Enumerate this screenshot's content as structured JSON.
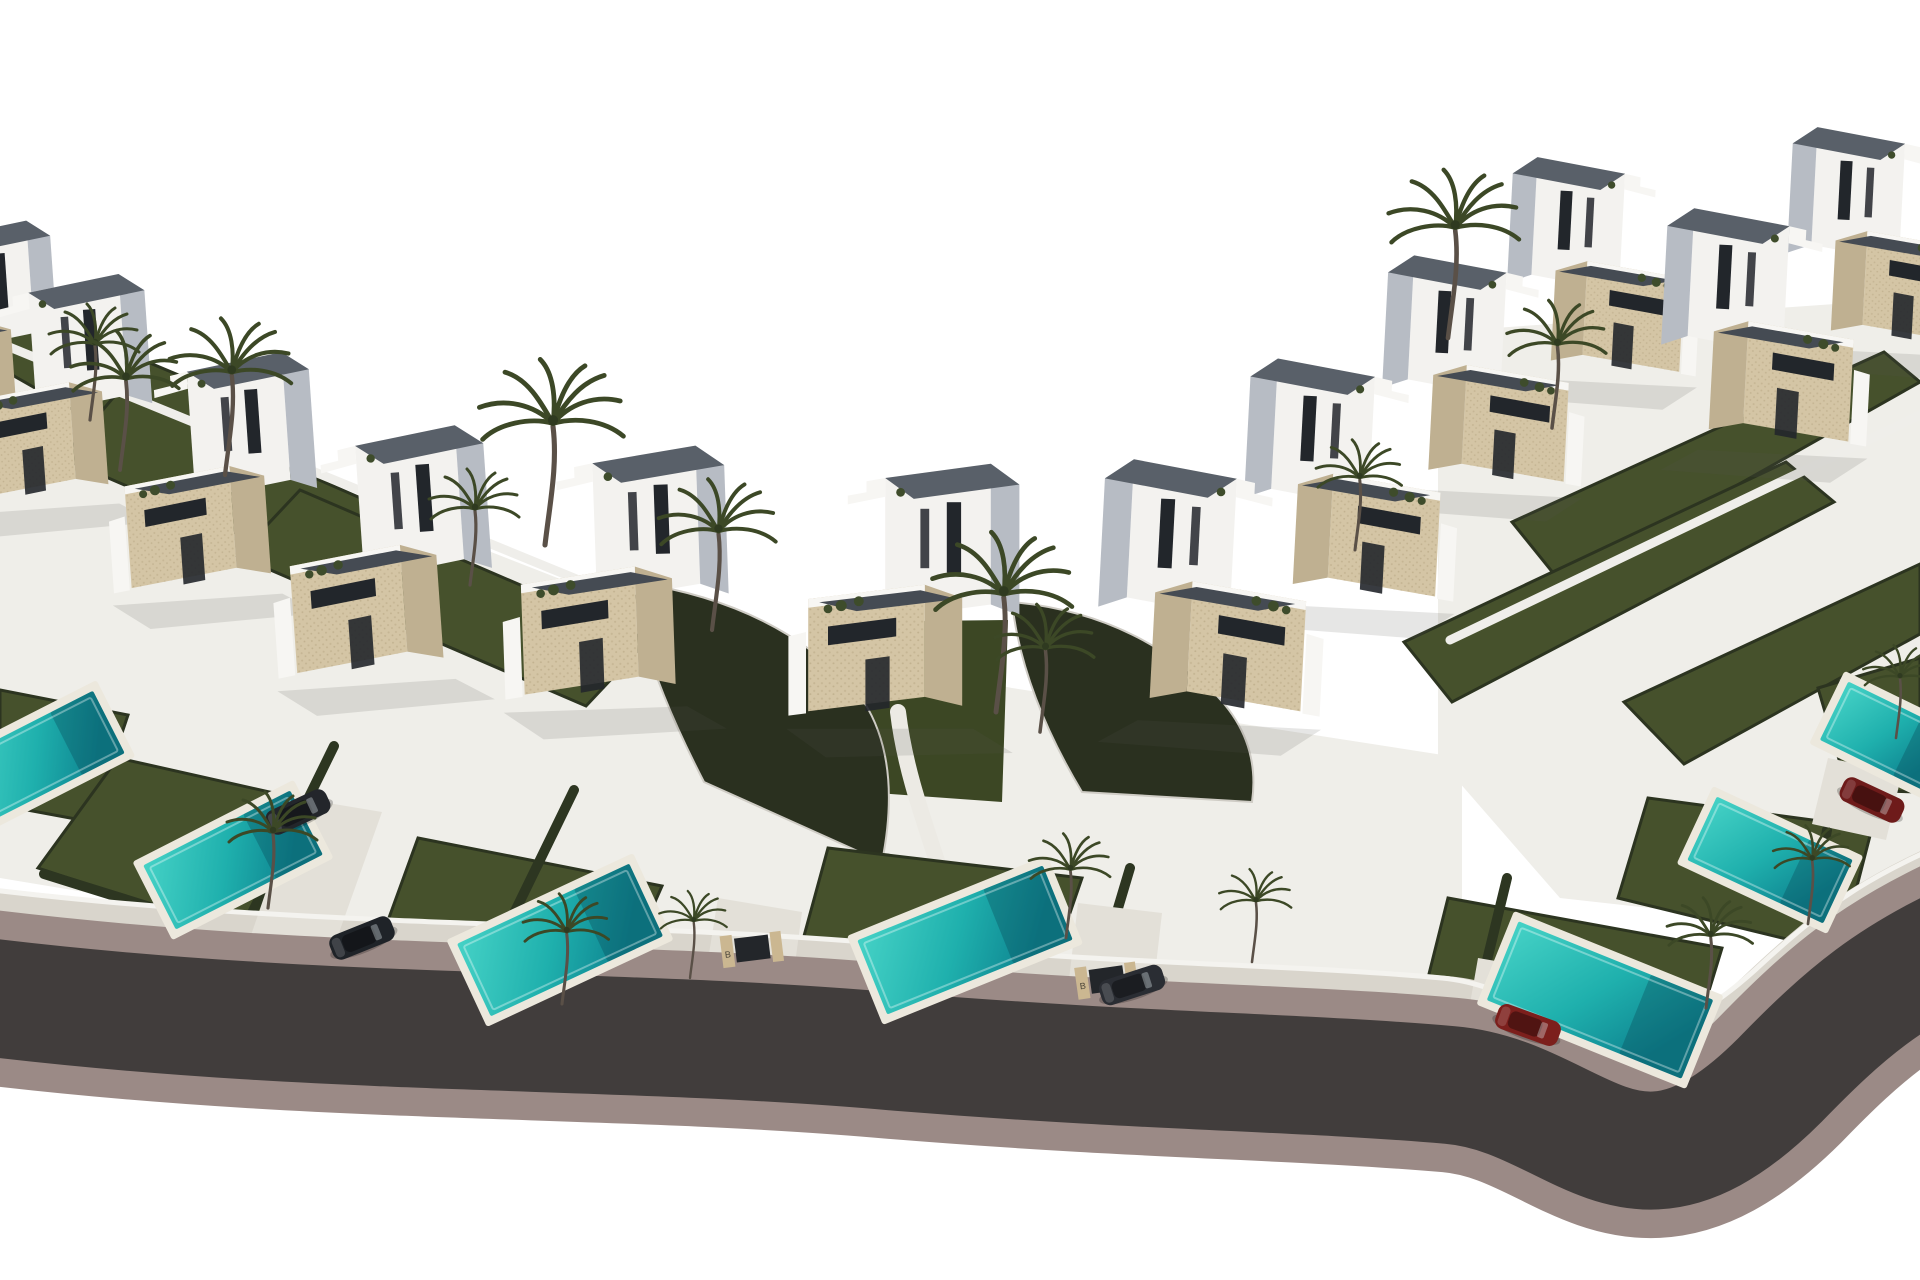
{
  "meta": {
    "description": "Aerial 3D architectural render of a gated development of modern two-storey villas with private pools and palm trees arranged along a sweeping curved road",
    "style": "computer generated real-estate visualization, white sky background"
  },
  "scene": {
    "width": 1920,
    "height": 1280,
    "colors": {
      "background": "#ffffff",
      "ground_tint": "#efeee9",
      "villa_white": "#f3f2ef",
      "villa_shadow": "#b7bcc4",
      "villa_trim": "#f7f6f3",
      "stone": "#d4c5a5",
      "stone_dark": "#bfb091",
      "roof": "#596069",
      "roof_dark": "#454b53",
      "window": "#22262b",
      "lawn": "#46512c",
      "lawn_valley": "#3c4724",
      "lawn_edge": "#2c3420",
      "hedge": "#2d3621",
      "embankment": "#2a301f",
      "pool_deck": "#ece8dd",
      "pool_light": "#45d2c6",
      "pool_mid": "#1fb0ad",
      "pool_deep": "#0e8490",
      "paving": "#dcd8cf",
      "driveway": "#e3e0d8",
      "sidewalk": "#d9d5cc",
      "curb": "#9b8a86",
      "asphalt": "#413d3c",
      "fence": "#f4f3ef",
      "wall": "#efeeea",
      "palm_frond": "#3c4826",
      "palm_trunk": "#5a5047",
      "shrub": "#3e4c2b",
      "shadow_soft": "rgba(90,90,80,0.15)"
    },
    "base_tints": [
      {
        "points": "0,360 660,618 1012,688 1012,1046 0,878"
      },
      {
        "points": "1012,688 1462,758 1462,1038 1012,1046"
      },
      {
        "points": "1438,332 1920,298 1920,938 1560,898 1438,758"
      }
    ],
    "back_lawns": [
      {
        "points": "0,300 238,400 186,474 0,368"
      },
      {
        "points": "118,392 452,538 396,602 62,458"
      },
      {
        "points": "300,490 648,640 586,706 238,556"
      },
      {
        "points": "1512,522 1884,352 1920,382 1562,584"
      },
      {
        "points": "1404,642 1786,462 1834,502 1452,702"
      },
      {
        "points": "1624,702 1920,564 1920,634 1684,764"
      }
    ],
    "perimeter_walls": [
      {
        "d": "M -20,335 L 640,605"
      },
      {
        "d": "M 1450,640 L 1920,415"
      }
    ],
    "valley": {
      "points": "828,622 1008,620 1002,802 862,792",
      "path_d": "M 898,712 C 904,762 918,804 938,864"
    },
    "embankments": [
      {
        "d": "M 632,582 Q 786,604 864,702 Q 902,762 882,862 L 704,782 Q 642,662 632,582 Z"
      },
      {
        "d": "M 1012,602 Q 1124,612 1202,682 Q 1262,732 1252,802 L 1082,792 Q 1022,692 1012,602 Z"
      }
    ],
    "front_lawns": [
      {
        "points": "0,690 128,715 92,822 0,805"
      },
      {
        "points": "118,758 332,806 262,942 38,868"
      },
      {
        "points": "418,838 662,886 602,1022 378,948"
      },
      {
        "points": "828,848 1082,878 1040,1000 798,958"
      },
      {
        "points": "1448,898 1722,948 1678,1092 1418,1018"
      },
      {
        "points": "1648,798 1872,828 1840,952 1618,898"
      },
      {
        "points": "1818,688 1920,658 1920,792 1848,790"
      }
    ],
    "hedges": [
      {
        "x1": 230,
        "y1": 958,
        "x2": 334,
        "y2": 746
      },
      {
        "x1": 468,
        "y1": 1008,
        "x2": 574,
        "y2": 790
      },
      {
        "x1": 1078,
        "y1": 1042,
        "x2": 1130,
        "y2": 868
      },
      {
        "x1": 1455,
        "y1": 1092,
        "x2": 1507,
        "y2": 878
      },
      {
        "x1": 1777,
        "y1": 1112,
        "x2": 1827,
        "y2": 830
      },
      {
        "x1": 44,
        "y1": 874,
        "x2": 256,
        "y2": 940
      }
    ],
    "road": {
      "center_d": "M -70,990 C 300,1040 600,1025 900,1052 C 1150,1072 1300,1072 1450,1085 C 1580,1096 1630,1230 1780,1080 C 1845,1013 1890,975 1980,935",
      "sidewalk_d": "M -70,912 C 300,962 600,948 900,975 C 1150,995 1300,995 1445,1008 C 1565,1018 1615,1140 1765,1000 C 1830,938 1880,900 1980,860",
      "fence_d": "M -70,882 C 300,932 600,918 900,945 C 1150,965 1300,965 1442,978 C 1555,988 1605,1105 1755,970 C 1822,908 1872,870 1980,830",
      "widths": {
        "curb": 175,
        "asphalt": 118,
        "sidewalk": 64,
        "fence": 5
      }
    },
    "driveways": [
      {
        "points": "298,798 382,812 330,958 248,944"
      },
      {
        "points": "718,898 802,912 792,986 706,972"
      },
      {
        "points": "1078,903 1162,913 1152,1000 1068,988"
      },
      {
        "points": "1478,958 1560,972 1548,1052 1464,1038"
      },
      {
        "points": "1828,758 1902,773 1886,840 1812,824"
      }
    ],
    "villas": [
      {
        "x": -28,
        "y": 430,
        "s": 0.88,
        "flip": false,
        "rot": -4
      },
      {
        "x": 60,
        "y": 500,
        "s": 0.95,
        "flip": false,
        "rot": -4
      },
      {
        "x": 220,
        "y": 590,
        "s": 1.0,
        "flip": false,
        "rot": -4
      },
      {
        "x": 390,
        "y": 675,
        "s": 1.05,
        "flip": false,
        "rot": -4
      },
      {
        "x": 620,
        "y": 700,
        "s": 1.08,
        "flip": false,
        "rot": -2
      },
      {
        "x": 905,
        "y": 720,
        "s": 1.1,
        "flip": false,
        "rot": 0
      },
      {
        "x": 1205,
        "y": 715,
        "s": 1.08,
        "flip": true,
        "rot": 3
      },
      {
        "x": 1345,
        "y": 600,
        "s": 1.02,
        "flip": true,
        "rot": 3
      },
      {
        "x": 1478,
        "y": 485,
        "s": 0.97,
        "flip": true,
        "rot": 3
      },
      {
        "x": 1598,
        "y": 375,
        "s": 0.92,
        "flip": true,
        "rot": 3
      },
      {
        "x": 1760,
        "y": 445,
        "s": 1.0,
        "flip": true,
        "rot": 3
      },
      {
        "x": 1878,
        "y": 345,
        "s": 0.92,
        "flip": true,
        "rot": 3
      }
    ],
    "pools": [
      {
        "cx": 42,
        "cy": 756,
        "w": 150,
        "h": 70,
        "rot": -27
      },
      {
        "cx": 233,
        "cy": 860,
        "w": 165,
        "h": 72,
        "rot": -27
      },
      {
        "cx": 560,
        "cy": 940,
        "w": 190,
        "h": 80,
        "rot": -25
      },
      {
        "cx": 965,
        "cy": 940,
        "w": 200,
        "h": 80,
        "rot": -22
      },
      {
        "cx": 1600,
        "cy": 1000,
        "w": 210,
        "h": 85,
        "rot": 22
      },
      {
        "cx": 1770,
        "cy": 860,
        "w": 150,
        "h": 70,
        "rot": 25
      },
      {
        "cx": 1888,
        "cy": 737,
        "w": 120,
        "h": 65,
        "rot": 26
      }
    ],
    "gates": {
      "label": "B",
      "items": [
        {
          "cx": 757,
          "cy": 962,
          "rot": -7
        },
        {
          "cx": 1112,
          "cy": 993,
          "rot": -8
        }
      ]
    },
    "cars": [
      {
        "cx": 298,
        "cy": 812,
        "rot": -25,
        "color": "#23262b"
      },
      {
        "cx": 362,
        "cy": 938,
        "rot": -22,
        "color": "#1f2328"
      },
      {
        "cx": 1132,
        "cy": 985,
        "rot": -18,
        "color": "#2a2d33"
      },
      {
        "cx": 1528,
        "cy": 1025,
        "rot": 20,
        "color": "#7c1f1c"
      },
      {
        "cx": 1872,
        "cy": 800,
        "rot": 25,
        "color": "#6e1b1a"
      }
    ],
    "palms": [
      {
        "x": 90,
        "y": 420,
        "s": 1.0
      },
      {
        "x": 120,
        "y": 470,
        "s": 1.2
      },
      {
        "x": 225,
        "y": 475,
        "s": 1.35
      },
      {
        "x": 545,
        "y": 545,
        "s": 1.6
      },
      {
        "x": 470,
        "y": 585,
        "s": 1.0
      },
      {
        "x": 712,
        "y": 630,
        "s": 1.3
      },
      {
        "x": 996,
        "y": 712,
        "s": 1.55
      },
      {
        "x": 1040,
        "y": 732,
        "s": 1.1
      },
      {
        "x": 1448,
        "y": 338,
        "s": 1.45
      },
      {
        "x": 1552,
        "y": 428,
        "s": 1.1
      },
      {
        "x": 1355,
        "y": 550,
        "s": 0.95
      },
      {
        "x": 268,
        "y": 908,
        "s": 1.0
      },
      {
        "x": 562,
        "y": 1004,
        "s": 0.95
      },
      {
        "x": 690,
        "y": 978,
        "s": 0.75
      },
      {
        "x": 1066,
        "y": 938,
        "s": 0.9
      },
      {
        "x": 1252,
        "y": 962,
        "s": 0.8
      },
      {
        "x": 1706,
        "y": 1008,
        "s": 0.95
      },
      {
        "x": 1808,
        "y": 924,
        "s": 0.85
      },
      {
        "x": 1896,
        "y": 738,
        "s": 0.8
      }
    ]
  }
}
